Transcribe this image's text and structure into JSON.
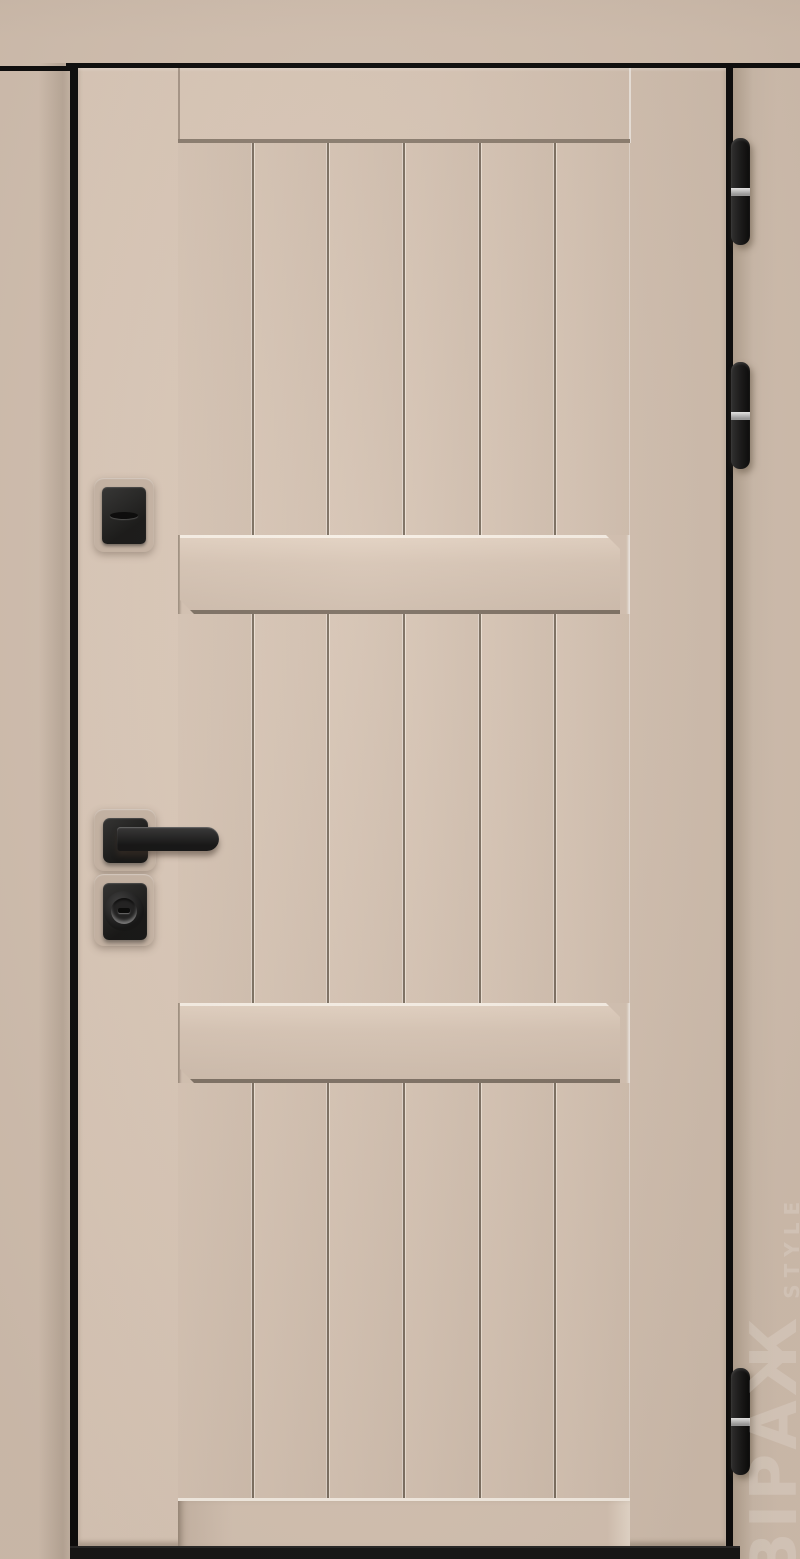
{
  "meta": {
    "scene": "entrance-door-product-photo",
    "description": "Straight-on product photo of a closed beige entrance door with vertical plank panelling, two raised crossbars, black key escutcheon, black lever handle, black cylinder escutcheon and three black edge hinges with steel rings"
  },
  "watermark": {
    "brand": "ВІРАЖ",
    "sub": "STYLE"
  },
  "colors": {
    "frame": "#d2c0b0",
    "frame_dark": "#c4b3a3",
    "door_face": "#d8c6b6",
    "door_face_dark": "#d0beae",
    "panel": "#d4c2b2",
    "groove": "#7c6f61",
    "groove_light": "#ece0d3",
    "bevel_light": "#f7efe5",
    "bevel_dark": "#7d7063",
    "edge_black": "#0a0a0a",
    "threshold": "#141414",
    "backplate": "#c6b4a4",
    "silver": "#9c9c9c",
    "watermark_color": "rgba(255,255,255,0.16)"
  },
  "door": {
    "planks_per_section": 6,
    "plank_sections": 3,
    "crossbars": 2,
    "hinges": [
      "top hinge",
      "middle hinge",
      "bottom hinge"
    ],
    "hardware": [
      "key escutcheon with flap",
      "lever handle on square rose",
      "armoured cylinder escutcheon"
    ]
  }
}
